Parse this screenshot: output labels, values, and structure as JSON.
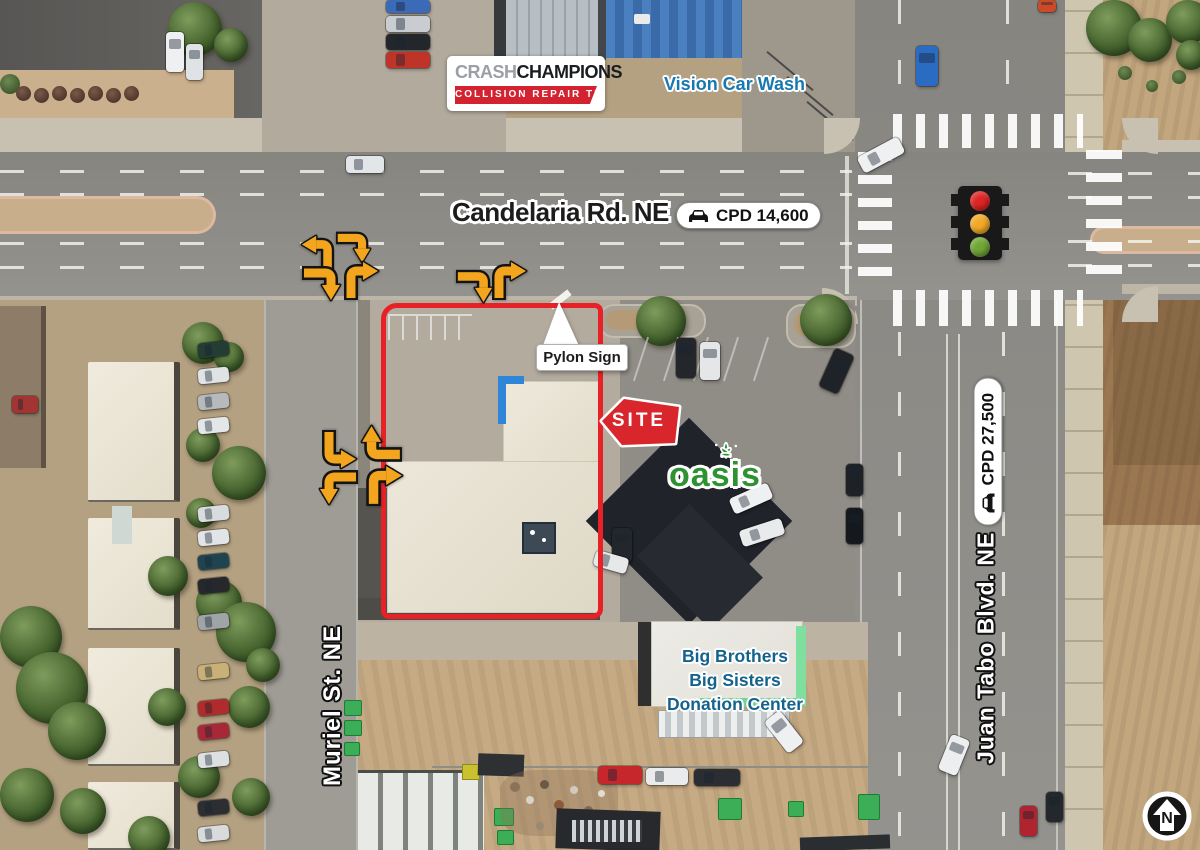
{
  "logo": {
    "crash": "CRASH",
    "champions": "CHAMPIONS",
    "tagline": "COLLISION REPAIR TEAM"
  },
  "businesses": {
    "vision_car_wash": "Vision Car Wash",
    "oasis": "oasis",
    "big_brothers": {
      "line1": "Big Brothers",
      "line2": "Big Sisters",
      "line3": "Donation Center"
    }
  },
  "roads": {
    "candelaria": {
      "name": "Candelaria Rd. NE",
      "cpd": "CPD 14,600"
    },
    "juan_tabo": {
      "name": "Juan Tabo Blvd. NE",
      "cpd": "CPD 27,500"
    },
    "muriel": {
      "name": "Muriel St. NE"
    }
  },
  "site": {
    "flag": "SITE",
    "pylon_sign": "Pylon Sign"
  },
  "compass": {
    "north": "N"
  },
  "colors": {
    "site_boundary": "#e82127",
    "site_flag": "#d9262c",
    "arrow_orange": "#f2a51d",
    "oasis_green": "#2f9232",
    "vision_blue": "#1878b2",
    "bbbs_teal": "#15638d",
    "traffic_red": "#e02424",
    "traffic_amber": "#f2a929",
    "traffic_green": "#70a636",
    "crash_red": "#d42330",
    "crash_gray": "#9aa0a6",
    "road_label": "#1c1c1c"
  }
}
